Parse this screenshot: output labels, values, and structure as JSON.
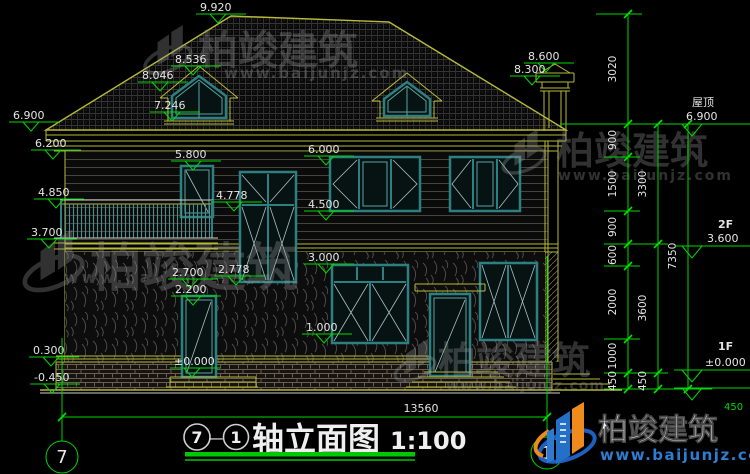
{
  "watermark": {
    "brand": "柏竣建筑",
    "url": "www.baijunjz.com"
  },
  "logo": {
    "brand": "柏竣建筑",
    "url": "www.baijunjz.com"
  },
  "title": {
    "axis_from": "7",
    "separator": "—",
    "axis_to": "1",
    "text": "轴立面图",
    "scale": "1:100"
  },
  "axes": {
    "left_bubble": "7",
    "right_bubble": "1"
  },
  "levels": {
    "peak": "9.920",
    "chimney_top": "8.600",
    "chimney_cap": "8.300",
    "dormer_ridge": "8.536",
    "dormer_eave": "8.046",
    "dormer_sill": "7.246",
    "eave": "6.900",
    "wall_top": "6.200",
    "win2_head": "6.000",
    "stair_head": "5.800",
    "rail_top": "4.850",
    "stair_mid": "4.778",
    "win2_sill": "4.500",
    "balcony": "3.700",
    "band": "3.000",
    "stair_sill": "2.778",
    "lintel": "2.700",
    "door_head": "2.200",
    "win1_sill": "1.000",
    "plinth_top": "0.300",
    "floor1": "±0.000",
    "site": "-0.450"
  },
  "floor_marks": {
    "roof_name": "屋顶",
    "roof_level": "6.900",
    "f2_name": "2F",
    "f2_level": "3.600",
    "f1_name": "1F",
    "f1_level": "±0.000",
    "site_offset": "450"
  },
  "dims": {
    "total_width": "13560",
    "chain_inner": [
      "3020",
      "900",
      "1500",
      "900",
      "600",
      "2000",
      "1000",
      "450"
    ],
    "chain_mid": [
      "3300",
      "3600",
      "450"
    ],
    "chain_outer": [
      "7350"
    ]
  }
}
